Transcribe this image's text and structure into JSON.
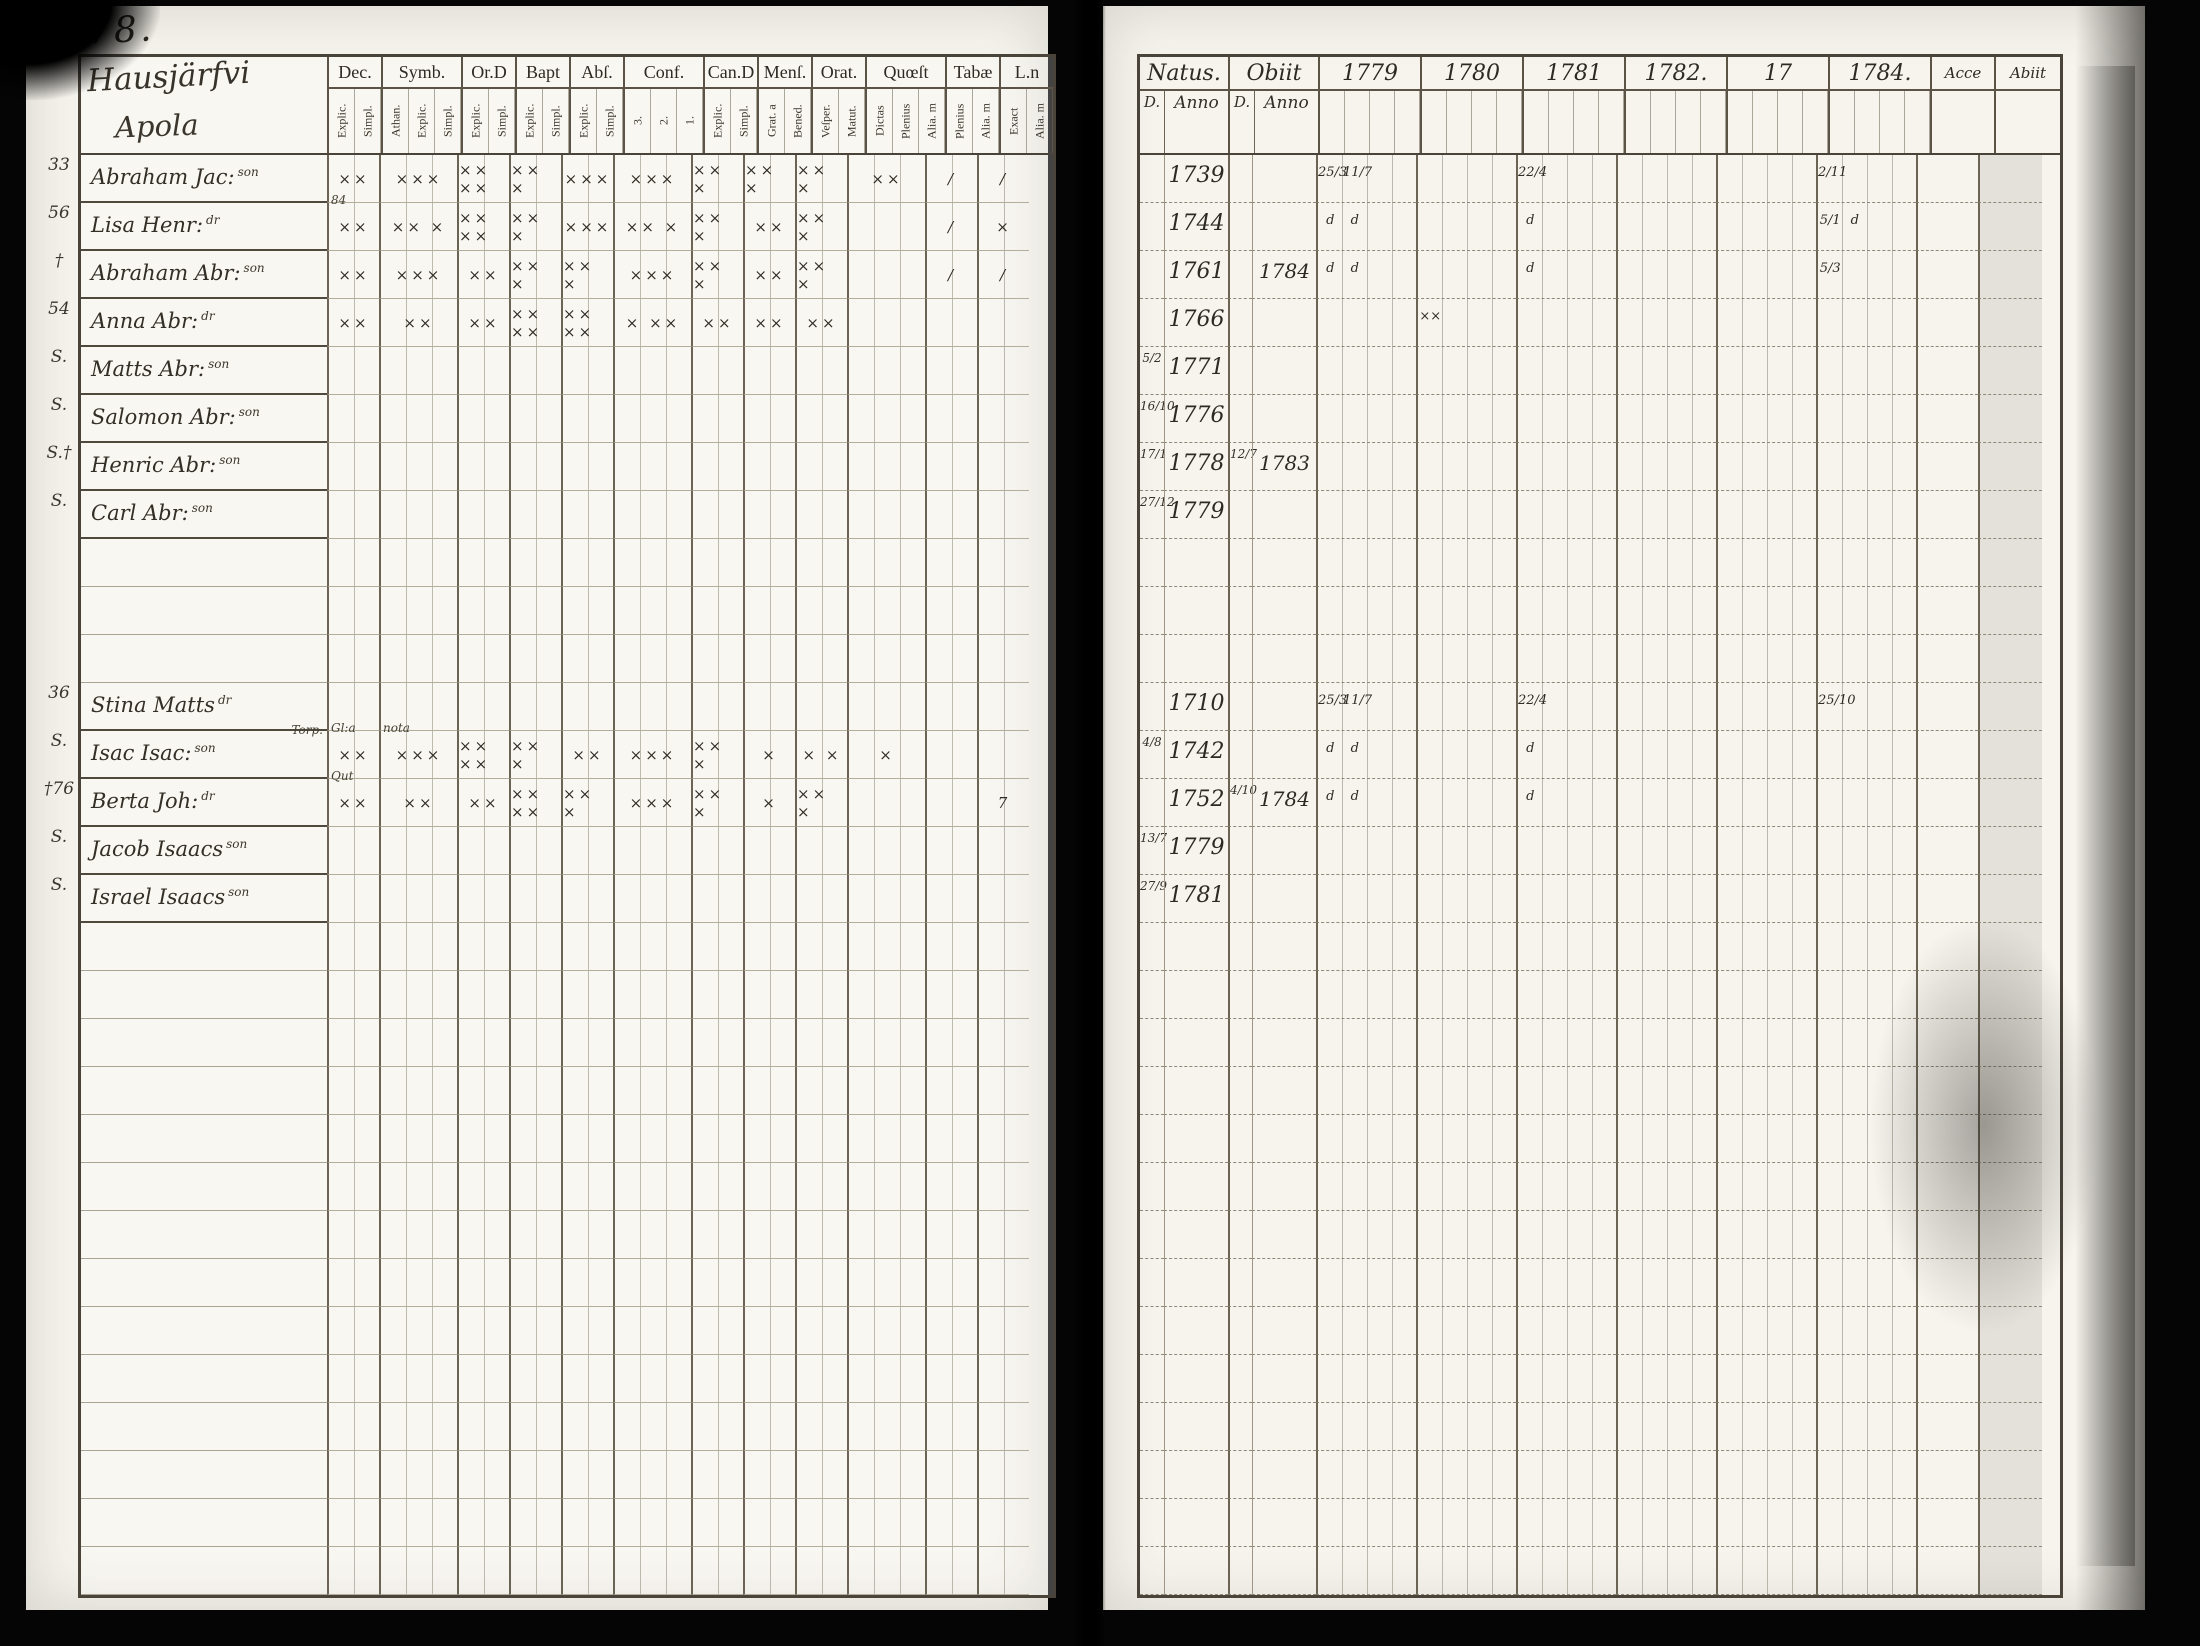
{
  "scan": {
    "page_number": "78."
  },
  "colors": {
    "paper": "#f6f4ed",
    "ink": "#332f27",
    "ruling": "#aba494",
    "table_border": "#49433a",
    "background": "#050505"
  },
  "left_page": {
    "title_line1": "Hausjärfvi",
    "title_line2": "Apola",
    "columns": [
      {
        "label": "Dec.",
        "subs": [
          "Explic.",
          "Simpl."
        ]
      },
      {
        "label": "Symb.",
        "subs": [
          "Athan.",
          "Explic.",
          "Simpl."
        ]
      },
      {
        "label": "Or.D",
        "subs": [
          "Explic.",
          "Simpl."
        ]
      },
      {
        "label": "Bapt",
        "subs": [
          "Explic.",
          "Simpl."
        ]
      },
      {
        "label": "Abſ.",
        "subs": [
          "Explic.",
          "Simpl."
        ]
      },
      {
        "label": "Conf.",
        "subs": [
          "3.",
          "2.",
          "1."
        ]
      },
      {
        "label": "Can.D",
        "subs": [
          "Explic.",
          "Simpl."
        ]
      },
      {
        "label": "Menſ.",
        "subs": [
          "Grat. a",
          "Bened."
        ]
      },
      {
        "label": "Orat.",
        "subs": [
          "Veſper.",
          "Matut."
        ]
      },
      {
        "label": "Quœſt",
        "subs": [
          "Dictas",
          "Plenius",
          "Alia. m"
        ]
      },
      {
        "label": "Tabæ",
        "subs": [
          "Plenius",
          "Alia. m"
        ]
      },
      {
        "label": "L.n",
        "subs": [
          "Exact",
          "Alia. m"
        ]
      }
    ],
    "rows": [
      {
        "margin": "33",
        "name": "Abraham Jac:",
        "sup": "son",
        "marks": [
          "××",
          "×××",
          "×× ××",
          "×× ×",
          "×××",
          "×××",
          "×× ×",
          "×× ×",
          "×× ×",
          "××",
          "/",
          "/"
        ]
      },
      {
        "margin": "56",
        "name": "Lisa Henr:",
        "sup": "dr",
        "note_dec": "84",
        "marks": [
          "××",
          "×× ×",
          "×× ××",
          "×× ×",
          "×××",
          "×× ×",
          "×× ×",
          "××",
          "×× ×",
          "",
          "/",
          "×"
        ]
      },
      {
        "margin": "†",
        "name": "Abraham Abr:",
        "sup": "son",
        "marks": [
          "××",
          "×××",
          "××",
          "×× ×",
          "×× ×",
          "×××",
          "×× ×",
          "××",
          "×× ×",
          "",
          "/",
          "/"
        ]
      },
      {
        "margin": "54",
        "name": "Anna Abr:",
        "sup": "dr",
        "marks": [
          "××",
          "××",
          "××",
          "×× ××",
          "×× ××",
          "× ××",
          "××",
          "××",
          "××",
          "",
          "",
          ""
        ]
      },
      {
        "margin": "S.",
        "name": "Matts Abr:",
        "sup": "son",
        "marks": []
      },
      {
        "margin": "S.",
        "name": "Salomon Abr:",
        "sup": "son",
        "marks": []
      },
      {
        "margin": "S.†",
        "name": "Henric Abr:",
        "sup": "son",
        "marks": []
      },
      {
        "margin": "S.",
        "name": "Carl Abr:",
        "sup": "son",
        "marks": []
      },
      {},
      {},
      {},
      {
        "margin": "36",
        "name": "Stina Matts",
        "sup": "dr",
        "marks": []
      },
      {
        "margin": "S.",
        "name": "Isac Isac:",
        "sup": "son",
        "note_name": "Torp.",
        "note_dec": "Gl:a",
        "note_symb": "nota",
        "marks": [
          "××",
          "×××",
          "×× ××",
          "×× ×",
          "××",
          "×××",
          "×× ×",
          "×",
          "× ×",
          "×",
          "",
          ""
        ]
      },
      {
        "margin": "†76",
        "name": "Berta Joh:",
        "sup": "dr",
        "note_dec": "Qut",
        "marks": [
          "××",
          "××",
          "××",
          "×× ××",
          "×× ×",
          "×××",
          "×× ×",
          "×",
          "×× ×",
          "",
          "",
          "7"
        ]
      },
      {
        "margin": "S.",
        "name": "Jacob Isaacs",
        "sup": "son",
        "marks": []
      },
      {
        "margin": "S.",
        "name": "Israel Isaacs",
        "sup": "son",
        "marks": []
      }
    ]
  },
  "right_page": {
    "natus_label": "Natus.",
    "obiit_label": "Obiit",
    "d_label": "D.",
    "anno_label": "Anno",
    "year_labels": [
      "1779",
      "1780",
      "1781",
      "1782.",
      "17",
      "1784."
    ],
    "acce_label": "Acce",
    "abiit_label": "Abiit",
    "rows": [
      {
        "natus": [
          "",
          "1739"
        ],
        "obiit": [
          "",
          ""
        ],
        "years": [
          [
            "25/3",
            "11/7"
          ],
          [],
          [
            "22/4"
          ],
          [],
          [],
          [
            "2/11"
          ]
        ]
      },
      {
        "natus": [
          "",
          "1744"
        ],
        "obiit": [
          "",
          ""
        ],
        "years": [
          [
            "d",
            "d"
          ],
          [],
          [
            "d"
          ],
          [],
          [],
          [
            "5/1",
            "d"
          ]
        ]
      },
      {
        "natus": [
          "",
          "1761"
        ],
        "obiit": [
          "",
          "1784"
        ],
        "years": [
          [
            "d",
            "d"
          ],
          [],
          [
            "d"
          ],
          [],
          [],
          [
            "5/3"
          ]
        ]
      },
      {
        "natus": [
          "",
          "1766"
        ],
        "obiit": [
          "",
          ""
        ],
        "years": [
          [],
          [
            "××"
          ],
          [],
          [],
          [],
          []
        ]
      },
      {
        "natus": [
          "5/2",
          "1771"
        ],
        "obiit": [
          "",
          ""
        ],
        "years": []
      },
      {
        "natus": [
          "16/10",
          "1776"
        ],
        "obiit": [
          "",
          ""
        ],
        "years": []
      },
      {
        "natus": [
          "17/1",
          "1778"
        ],
        "obiit": [
          "12/7",
          "1783"
        ],
        "years": []
      },
      {
        "natus": [
          "27/12",
          "1779"
        ],
        "obiit": [
          "",
          ""
        ],
        "years": []
      },
      {},
      {},
      {},
      {
        "natus": [
          "",
          "1710"
        ],
        "obiit": [
          "",
          ""
        ],
        "years": [
          [
            "25/3",
            "11/7"
          ],
          [],
          [
            "22/4"
          ],
          [],
          [],
          [
            "25/10"
          ]
        ]
      },
      {
        "natus": [
          "4/8",
          "1742"
        ],
        "obiit": [
          "",
          ""
        ],
        "years": [
          [
            "d",
            "d"
          ],
          [],
          [
            "d"
          ],
          [],
          [],
          []
        ]
      },
      {
        "natus": [
          "",
          "1752"
        ],
        "obiit": [
          "4/10",
          "1784"
        ],
        "years": [
          [
            "d",
            "d"
          ],
          [],
          [
            "d"
          ],
          [],
          [],
          []
        ]
      },
      {
        "natus": [
          "13/7",
          "1779"
        ],
        "obiit": [
          "",
          ""
        ],
        "years": []
      },
      {
        "natus": [
          "27/9",
          "1781"
        ],
        "obiit": [
          "",
          ""
        ],
        "years": []
      }
    ]
  }
}
